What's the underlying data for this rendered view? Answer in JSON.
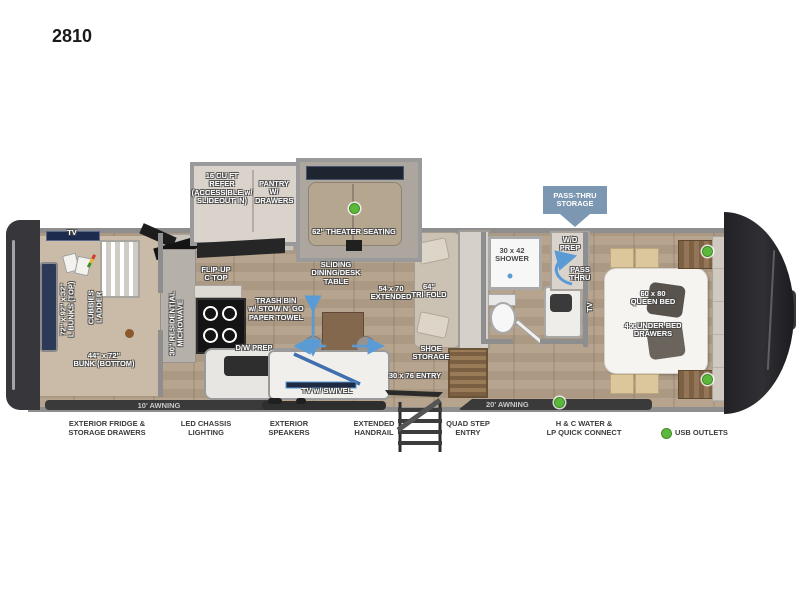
{
  "title": "2810",
  "slideouts": {
    "refer": "16 CU FT\nREFER\n(ACCESSIBLE w/\nSLIDEOUT IN)",
    "pantry": "PANTRY\nW/\nDRAWERS",
    "theater": "62\" THEATER SEATING"
  },
  "storage_flag": "PASS-THRU\nSTORAGE",
  "bunk_room": {
    "tv": "TV",
    "bunks_top": "72\" x 92\" x 32\"\nL BUNKS (TOP)",
    "cubbies_ladder": "CUBBIES\nLADDER",
    "bunk_bottom": "44\" x 72\"\nBUNK (BOTTOM)"
  },
  "kitchen": {
    "microwave": "30\" RESIDENTIAL\nMICROWAVE",
    "flip_up_ctop": "FLIP-UP\nC-TOP",
    "trash_bin": "TRASH BIN\nw/ STOW N' GO\nPAPER TOWEL",
    "dw_prep": "D/W PREP"
  },
  "living": {
    "dining_table": "SLIDING\nDINING/DESK\nTABLE",
    "table_extended": "54 x 70\nEXTENDED",
    "sofa": "64\"\nTRI-FOLD",
    "shoe_storage": "SHOE\nSTORAGE",
    "entry": "30 x 76 ENTRY"
  },
  "bathroom": {
    "shower": "30 x 42\nSHOWER",
    "wd_prep": "W/D\nPREP",
    "pass_thru": "PASS\nTHRU"
  },
  "bedroom": {
    "bed": "60 x 80\nQUEEN BED",
    "drawers": "4 x UNDER BED\nDRAWERS",
    "tv": "TV"
  },
  "exterior": {
    "awning_front": "10' AWNING",
    "awning_main": "20' AWNING",
    "tv_swivel": "TV w/ SWIVEL",
    "fridge": "EXTERIOR FRIDGE &\nSTORAGE DRAWERS",
    "chassis_lighting": "LED CHASSIS\nLIGHTING",
    "speakers": "EXTERIOR\nSPEAKERS",
    "handrail": "EXTENDED\nHANDRAIL",
    "quad_step": "QUAD STEP\nENTRY",
    "water": "H & C WATER &\nLP QUICK CONNECT"
  },
  "legend": {
    "usb": "USB OUTLETS"
  },
  "colors": {
    "accent_green": "#5cb83a",
    "flag_blue": "#7b97b2",
    "arrow_blue": "#5b9bd5"
  }
}
